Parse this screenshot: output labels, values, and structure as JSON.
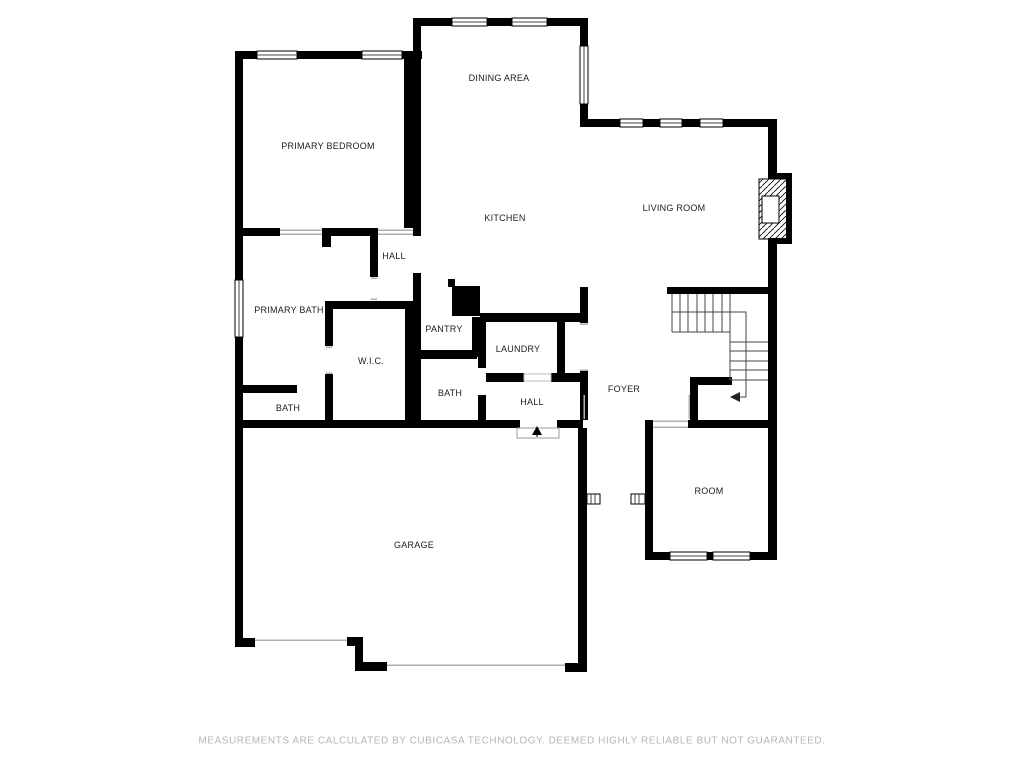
{
  "plan": {
    "rooms": {
      "primary_bedroom": {
        "label": "PRIMARY BEDROOM"
      },
      "dining_area": {
        "label": "DINING AREA"
      },
      "kitchen": {
        "label": "KITCHEN"
      },
      "living_room": {
        "label": "LIVING ROOM"
      },
      "hall_bedroom": {
        "label": "HALL"
      },
      "primary_bath": {
        "label": "PRIMARY BATH"
      },
      "pantry": {
        "label": "PANTRY"
      },
      "laundry": {
        "label": "LAUNDRY"
      },
      "wic": {
        "label": "W.I.C."
      },
      "bath_primary_suite": {
        "label": "BATH"
      },
      "bath_middle": {
        "label": "BATH"
      },
      "hall_entry": {
        "label": "HALL"
      },
      "foyer": {
        "label": "FOYER"
      },
      "room": {
        "label": "ROOM"
      },
      "garage": {
        "label": "GARAGE"
      }
    },
    "symbols": {
      "staircase": "staircase-icon",
      "fireplace": "fireplace-icon",
      "entry_door_arrow": "door-arrow-icon",
      "garage_doors": "garage-door-opening",
      "windows": "window-icon"
    },
    "colors": {
      "wall": "#000000",
      "background": "#ffffff",
      "label": "#1c1c1c",
      "thin_line": "#b0b0b0",
      "disclaimer": "#b6b6ba"
    }
  },
  "footer": {
    "disclaimer": "MEASUREMENTS ARE CALCULATED BY CUBICASA TECHNOLOGY. DEEMED HIGHLY RELIABLE BUT NOT GUARANTEED."
  }
}
